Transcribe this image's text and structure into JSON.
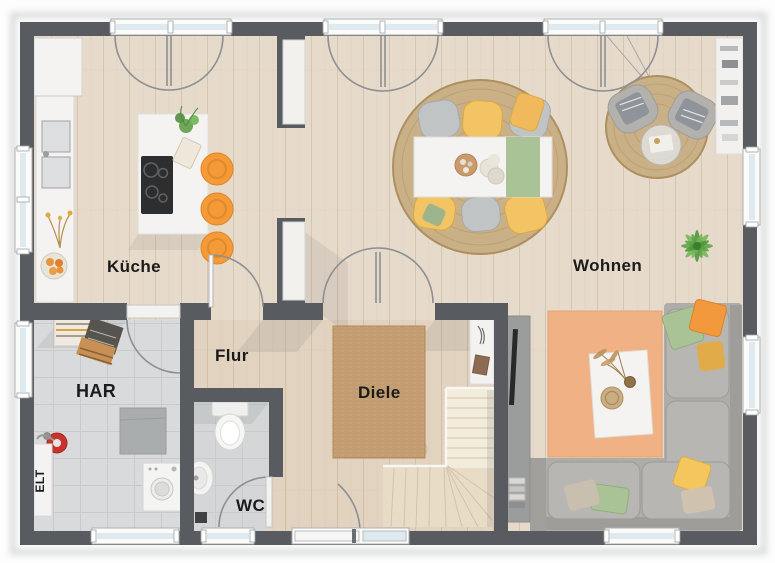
{
  "labels": {
    "kueche": "Küche",
    "wohnen": "Wohnen",
    "flur": "Flur",
    "diele": "Diele",
    "har": "HAR",
    "wc": "WC",
    "elt": "ELT"
  },
  "colors": {
    "wall": "#585c61",
    "floor_wood": "#e6dacb",
    "floor_tile": "#d8dadb",
    "rug_jute": "#cab087",
    "rug_diele": "#c7a276",
    "rug_orange": "#f0b184",
    "sofa": "#aeadа9",
    "sofa_base": "#aeada9",
    "stool_orange": "#f49b38",
    "chair_yellow": "#f2c464",
    "chair_gray": "#c0c4c4",
    "accent_green": "#a9c296",
    "furniture_white": "#f4f3f1",
    "window_glass": "#dfeaf0",
    "door_arc": "#8d9092",
    "stairs": "#e9dcc6",
    "tv_board": "#9b9d9c",
    "text": "#1b1b1b"
  }
}
